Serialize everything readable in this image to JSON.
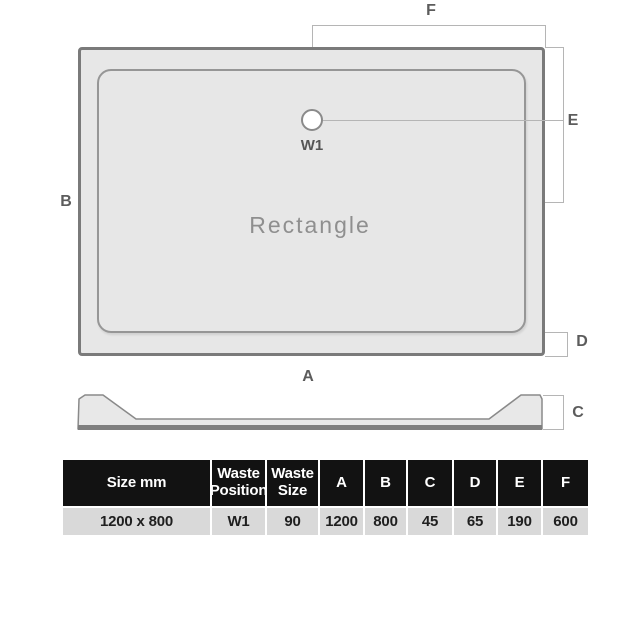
{
  "plan_view": {
    "shape_label": "Rectangle",
    "waste_position_label": "W1"
  },
  "dimension_labels": {
    "a": "A",
    "b": "B",
    "c": "C",
    "d": "D",
    "e": "E",
    "f": "F"
  },
  "table": {
    "headers": [
      "Size mm",
      "Waste Position",
      "Waste Size",
      "A",
      "B",
      "C",
      "D",
      "E",
      "F"
    ],
    "row": [
      "1200 x 800",
      "W1",
      "90",
      "1200",
      "800",
      "45",
      "65",
      "190",
      "600"
    ]
  },
  "colors": {
    "tray_fill": "#e7e7e7",
    "tray_border": "#7a7a7a",
    "inner_border": "#969696",
    "dimension_line": "#b5b5b5",
    "label_text": "#5c5c5c",
    "shape_label_text": "#8f8f8f",
    "table_header_bg": "#121212",
    "table_header_text": "#ffffff",
    "table_row_bg": "#d9d9d9",
    "table_row_text": "#1f1f1f"
  }
}
